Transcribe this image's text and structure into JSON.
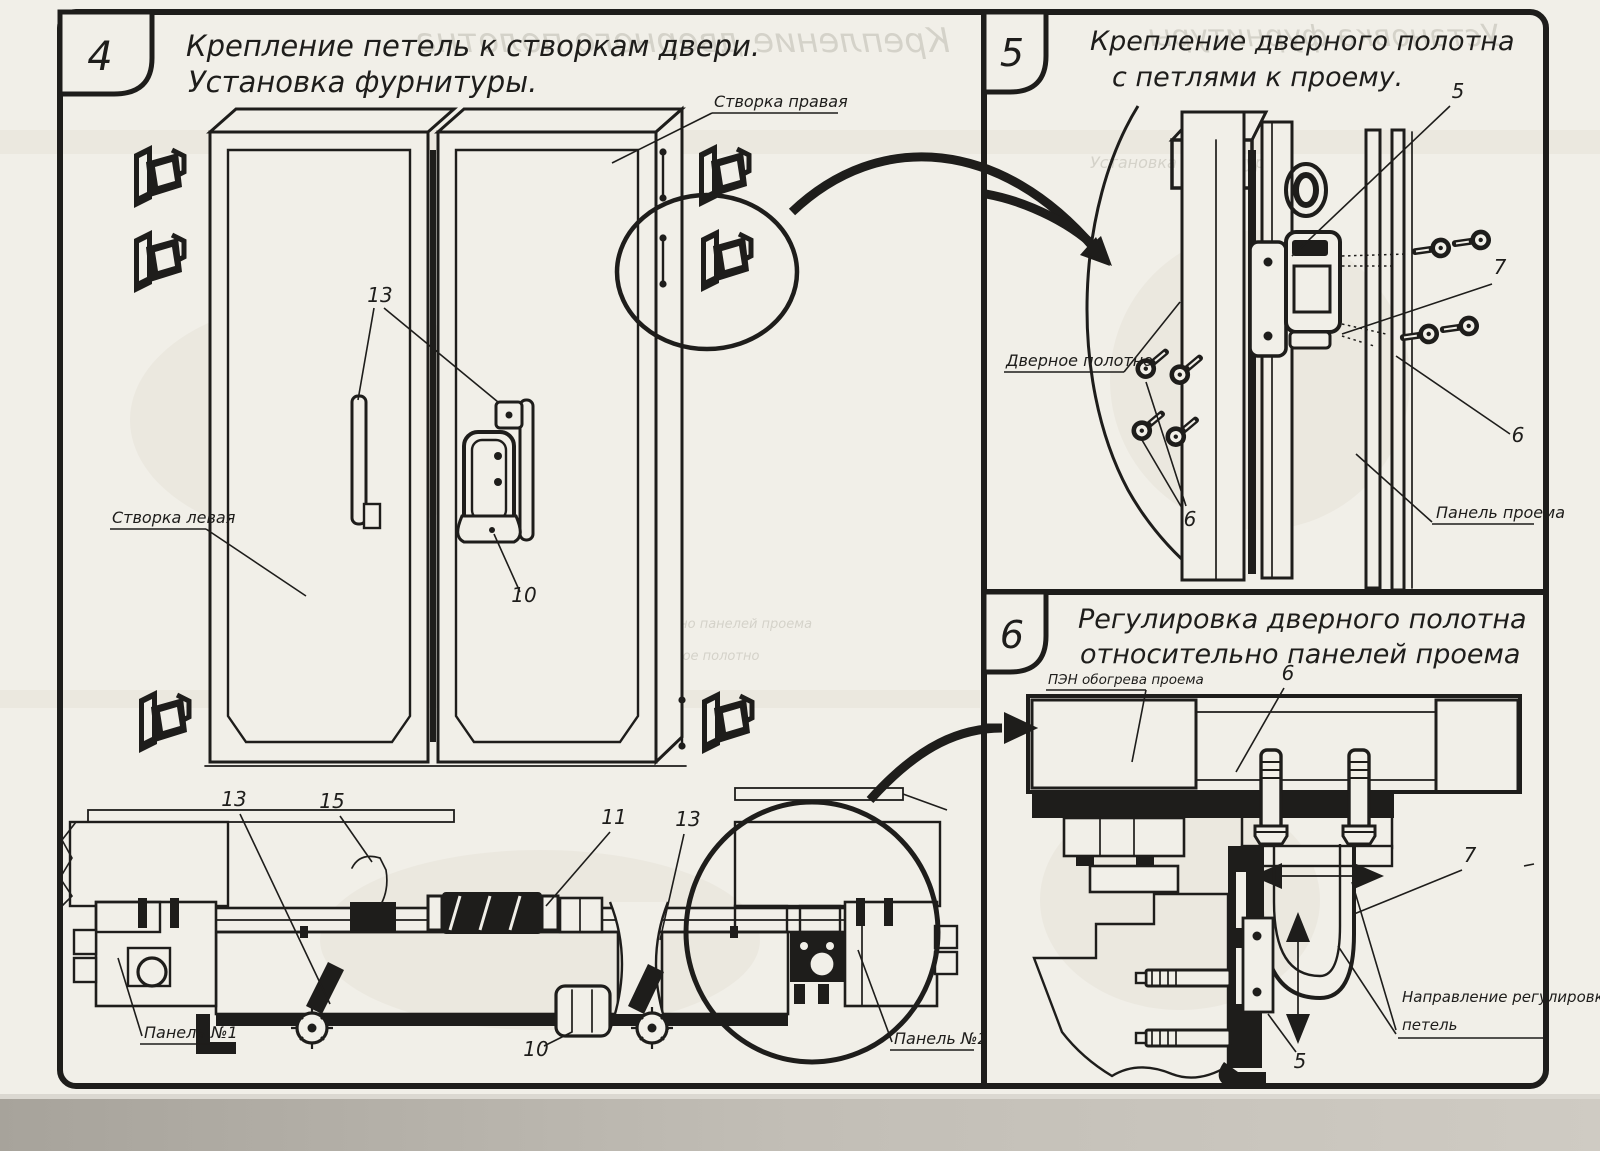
{
  "sheet": {
    "ink_color": "#1e1d1b",
    "paper_color": "#f1efe8"
  },
  "step4": {
    "number": "4",
    "title_line1": "Крепление петель к створкам двери.",
    "title_line2": "Установка фурнитуры.",
    "labels": {
      "right_leaf": "Створка правая",
      "left_leaf": "Створка левая",
      "panel_no1": "Панель №1",
      "panel_no2": "Панель №2"
    },
    "callouts": {
      "hinge_handle": "13",
      "lever": "15",
      "lock": "11",
      "latch": "10"
    }
  },
  "step5": {
    "number": "5",
    "title_line1": "Крепление дверного полотна",
    "title_line2": "с петлями к проему.",
    "labels": {
      "door_leaf": "Дверное полотно",
      "opening_panel": "Панель проема"
    },
    "callouts": {
      "hinge": "5",
      "screw": "6",
      "bracket": "7"
    }
  },
  "step6": {
    "number": "6",
    "title_line1": "Регулировка дверного полотна",
    "title_line2": "относительно панелей проема",
    "labels": {
      "heater": "ПЭН обогрева проема",
      "direction_line1": "Направление регулировки",
      "direction_line2": "петель"
    },
    "callouts": {
      "hinge": "5",
      "bolt": "6",
      "strap": "7"
    }
  }
}
